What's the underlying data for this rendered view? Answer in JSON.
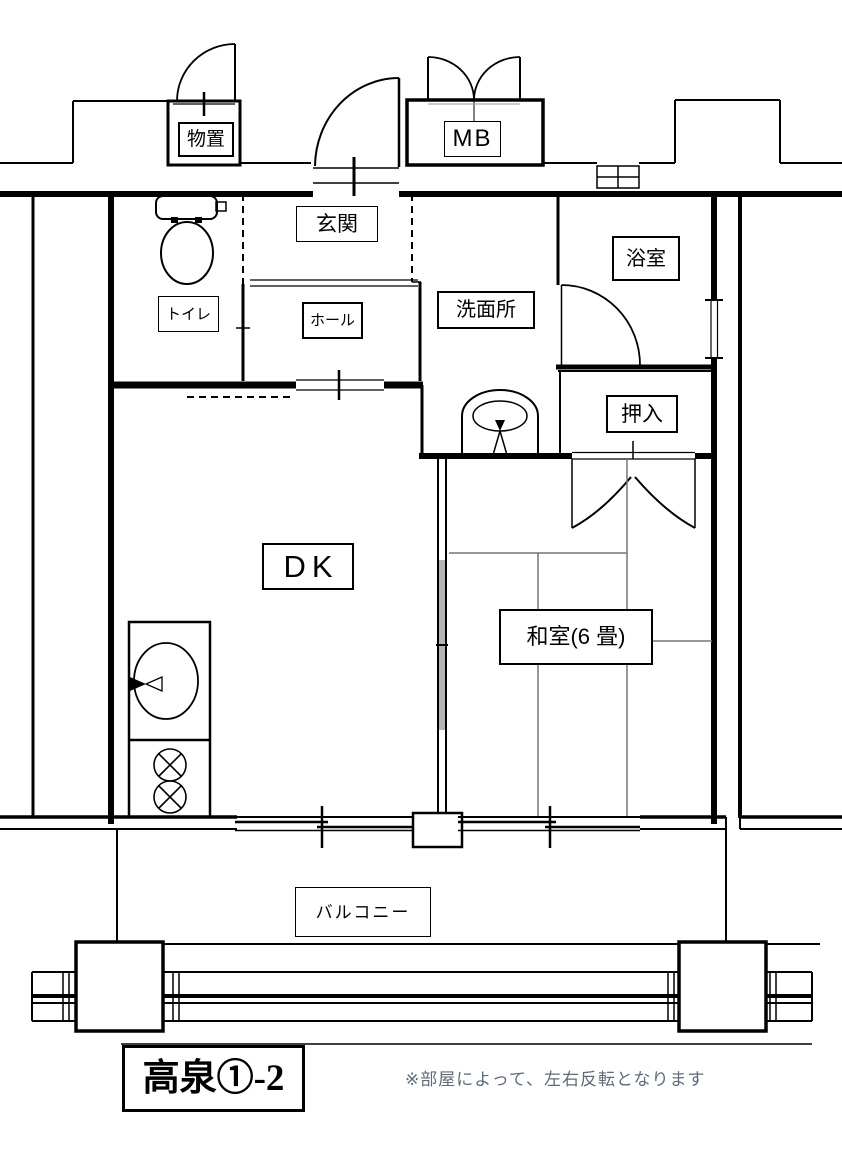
{
  "plan": {
    "labels": {
      "storage": "物置",
      "meter_box": "MB",
      "entrance": "玄関",
      "hall": "ホール",
      "toilet": "トイレ",
      "bathroom": "浴室",
      "washroom": "洗面所",
      "closet": "押入",
      "dining_kitchen": "DK",
      "japanese_room": "和室(6 畳)",
      "balcony": "バルコニー"
    },
    "title": "高泉①-2",
    "note": "※部屋によって、左右反転となります",
    "icons": [
      "toilet-icon",
      "washing-machine-icon",
      "kitchen-sink-icon",
      "stove-burners-icon",
      "door-swing-arc",
      "sliding-window",
      "vent-grille"
    ],
    "colors": {
      "line": "#000000",
      "note_text": "#5f6b7b",
      "tatami_line": "#777777",
      "partition_fill": "#b3b3b3"
    }
  }
}
